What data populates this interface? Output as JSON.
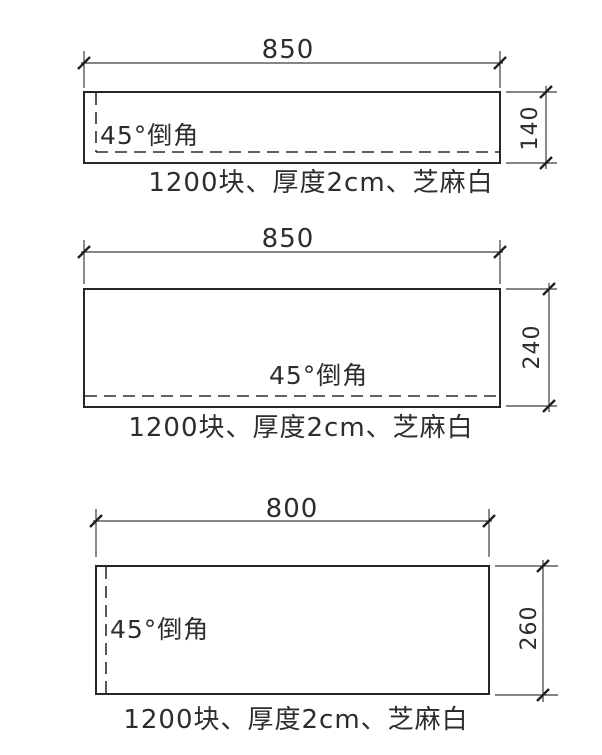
{
  "drawing_type": "stone-panel-fabrication-elevations",
  "colors": {
    "background": "#ffffff",
    "line": "#262626",
    "text": "#2d2d2d"
  },
  "panels": [
    {
      "width_value": 850,
      "width_label": "850",
      "height_value": 140,
      "height_label": "140",
      "chamfer_label": "45°倒角",
      "caption": "1200块、厚度2cm、芝麻白"
    },
    {
      "width_value": 850,
      "width_label": "850",
      "height_value": 240,
      "height_label": "240",
      "chamfer_label": "45°倒角",
      "caption": "1200块、厚度2cm、芝麻白"
    },
    {
      "width_value": 800,
      "width_label": "800",
      "height_value": 260,
      "height_label": "260",
      "chamfer_label": "45°倒角",
      "caption": "1200块、厚度2cm、芝麻白"
    }
  ]
}
